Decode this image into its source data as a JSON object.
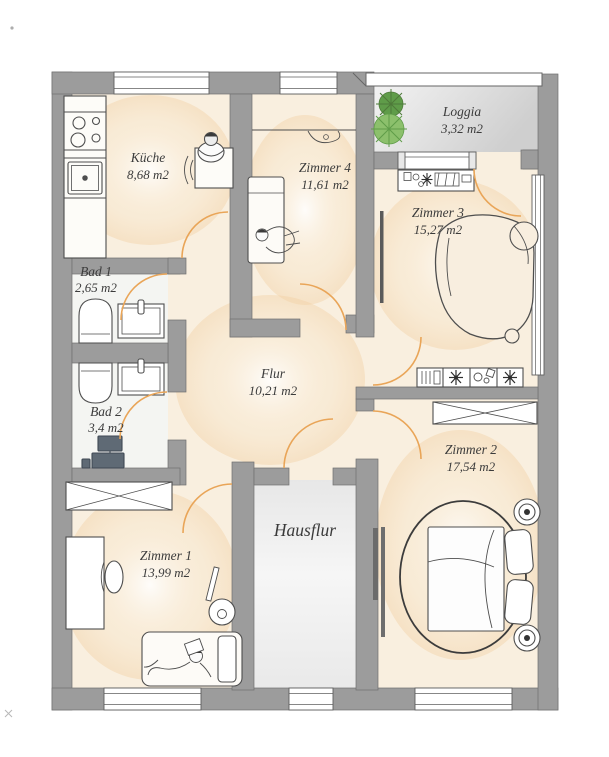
{
  "plan": {
    "type": "apartment-floor-plan",
    "language": "de"
  },
  "rooms": {
    "kueche": {
      "name": "Küche",
      "area": "8,68 m2"
    },
    "zimmer4": {
      "name": "Zimmer 4",
      "area": "11,61 m2"
    },
    "loggia": {
      "name": "Loggia",
      "area": "3,32 m2"
    },
    "zimmer3": {
      "name": "Zimmer 3",
      "area": "15,27 m2"
    },
    "bad1": {
      "name": "Bad 1",
      "area": "2,65 m2"
    },
    "bad2": {
      "name": "Bad 2",
      "area": "3,4 m2"
    },
    "flur": {
      "name": "Flur",
      "area": "10,21 m2"
    },
    "zimmer2": {
      "name": "Zimmer 2",
      "area": "17,54 m2"
    },
    "zimmer1": {
      "name": "Zimmer 1",
      "area": "13,99 m2"
    },
    "hausflur": {
      "name": "Hausflur"
    }
  },
  "colors": {
    "wall": "#9c9c9c",
    "wall_outline": "#717171",
    "floor_beige": "#f9efdf",
    "bath_floor": "#f4f5f2",
    "loggia_floor": "#d8d8d8",
    "door_arc": "#e9a558",
    "plant_green": "#8cc06c",
    "plant_green_dark": "#5f9c49",
    "furniture_line": "#4e4e4e",
    "label_text": "#3b3b3b"
  }
}
